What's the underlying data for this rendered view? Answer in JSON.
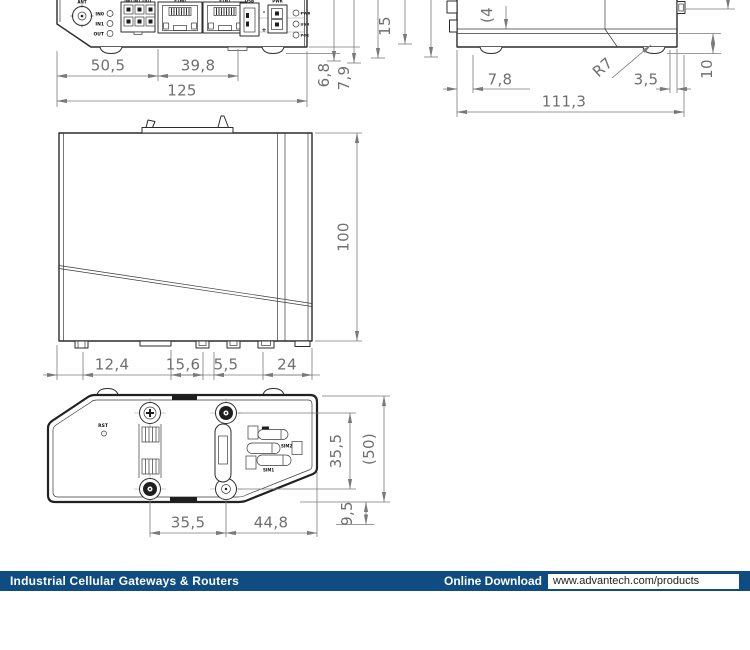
{
  "page": {
    "background": "#ffffff",
    "edge_color": "#2b2b2b",
    "dim_color": "#7a7a7a"
  },
  "front_view": {
    "ports": {
      "ant": "ANT",
      "header": "IN0 IN1 OUT",
      "eth0": "ETH0",
      "eth1": "ETH1",
      "usb": "USB",
      "pwr": "PWR",
      "minus": "-",
      "plus": "+"
    },
    "io": [
      "IN0",
      "IN1",
      "OUT"
    ],
    "leds": [
      "PWR",
      "USR",
      "POE"
    ],
    "dims": {
      "w1": "50,5",
      "w2": "39,8",
      "w_total": "125",
      "h_foot": "6,8",
      "h_clip": "7,9"
    }
  },
  "side_view": {
    "dims": {
      "v_left": "15",
      "v_top": "(4",
      "inset": "7,8",
      "radius": "R7",
      "chamfer": "3,5",
      "total": "111,3",
      "base": "10"
    }
  },
  "top_view": {
    "dims": {
      "height": "100",
      "s1": "12,4",
      "s2": "15,6",
      "s3": "5,5",
      "s4": "24"
    }
  },
  "bottom_view": {
    "reset": "RST",
    "sim2": "SIM2",
    "sim1": "SIM1",
    "dims": {
      "w1": "35,5",
      "w2": "44,8",
      "v1": "35,5",
      "v2": "(50)",
      "v3": "9,5"
    }
  },
  "footer": {
    "bar_color": "#0f4c81",
    "category": "Industrial Cellular Gateways & Routers",
    "download": "Online Download",
    "url": "www.advantech.com/products"
  }
}
